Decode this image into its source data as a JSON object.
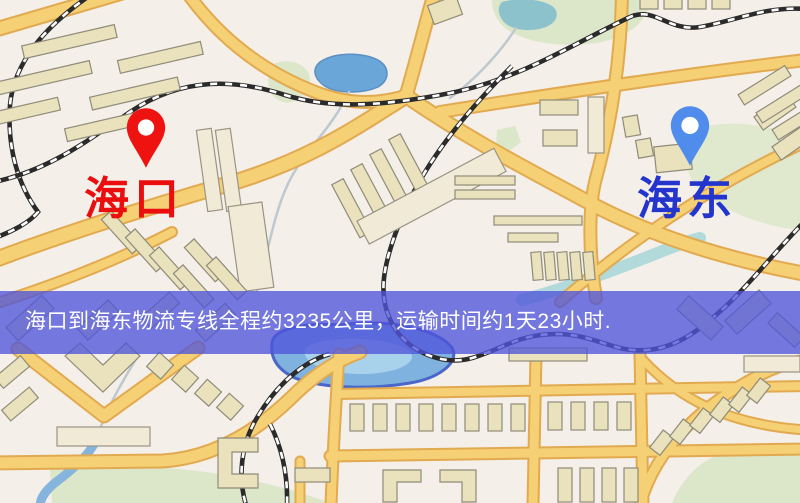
{
  "banner": {
    "text": "海口到海东物流专线全程约3235公里，运输时间约1天23小时.",
    "background": "rgba(80,84,218,0.78)",
    "text_color": "#ffffff",
    "distance_km": "3235",
    "duration_text": "1天23小时"
  },
  "markers": {
    "origin": {
      "label": "海口",
      "label_color": "#ea0e0e",
      "pin_color": "#ee1311"
    },
    "destination": {
      "label": "海东",
      "label_color": "#2435cd",
      "pin_color": "#4f8cec"
    }
  },
  "map": {
    "background": "#f4efe8",
    "road_color": "#f6d075",
    "road_casing_color": "#e2aa50",
    "building_color": "#eae1bd",
    "water_color": "#7fb2de",
    "park_color": "#dce6c9",
    "railway_color": "#2b2b2b"
  }
}
